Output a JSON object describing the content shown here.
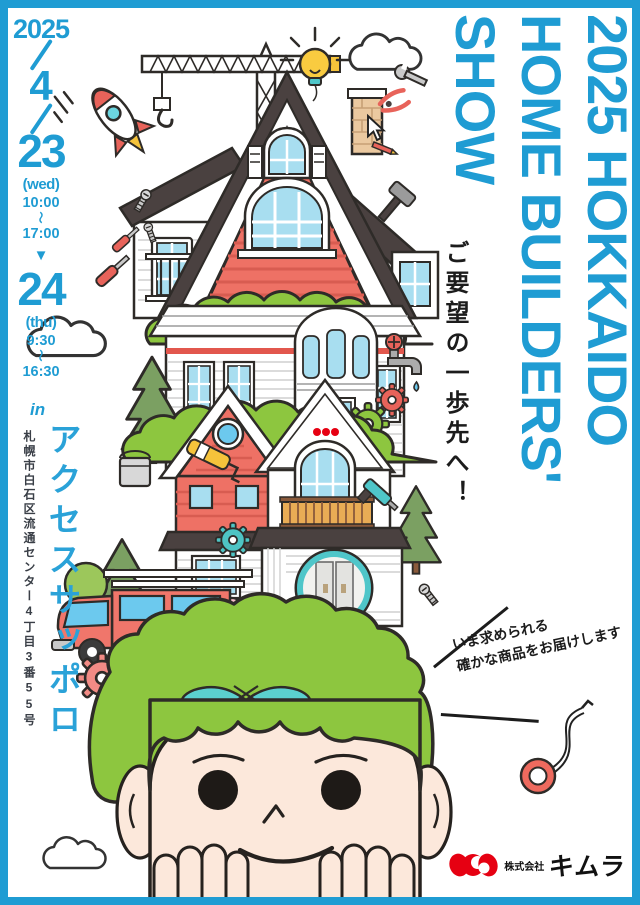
{
  "title": {
    "line1": "2025 HOKKAIDO",
    "line2": "HOME BUILDERS'",
    "line3": "SHOW"
  },
  "tagline": "ご要望の一歩先へ！",
  "schedule": {
    "year": "2025",
    "month": "4",
    "day1": {
      "date": "23",
      "dow": "(wed)",
      "open": "10:00",
      "close": "17:00"
    },
    "day2": {
      "date": "24",
      "dow": "(thu)",
      "open": "9:30",
      "close": "16:30"
    },
    "tilde": "〜",
    "arrow": "▼"
  },
  "venue": {
    "in_label": "in",
    "name": "アクセスサッポロ",
    "address": "札幌市白石区流通センター4丁目3番55号"
  },
  "slogan": {
    "line1": "いま求められる",
    "line2": "確かな商品をお届けします"
  },
  "company": {
    "prefix": "株式会社",
    "name": "キムラ"
  },
  "colors": {
    "accent_blue": "#1F9CD3",
    "text_black": "#1C1C1C",
    "house_red": "#EE7165",
    "leaf_green": "#8DC63F",
    "teal": "#4FC6C9",
    "roof_dark": "#4A4140",
    "skin": "#FCE8DB",
    "logo_red": "#E60012"
  },
  "illustration": {
    "icons": [
      "tower-crane-icon",
      "lightbulb-icon",
      "cloud-icon",
      "rocket-icon",
      "chimney-icon",
      "stacked-house-icon",
      "bush-icon",
      "pine-tree-icon",
      "gear-icon",
      "paint-roller-icon",
      "paint-bucket-icon",
      "faucet-icon",
      "magnifying-glass-icon",
      "truck-icon",
      "shears-icon",
      "boy-face-icon",
      "hammer-icon",
      "wrench-icon",
      "screwdriver-icon",
      "screw-icon",
      "cursor-arrow-icon",
      "pencil-icon",
      "caulk-gun-icon",
      "tape-measure-icon"
    ]
  }
}
